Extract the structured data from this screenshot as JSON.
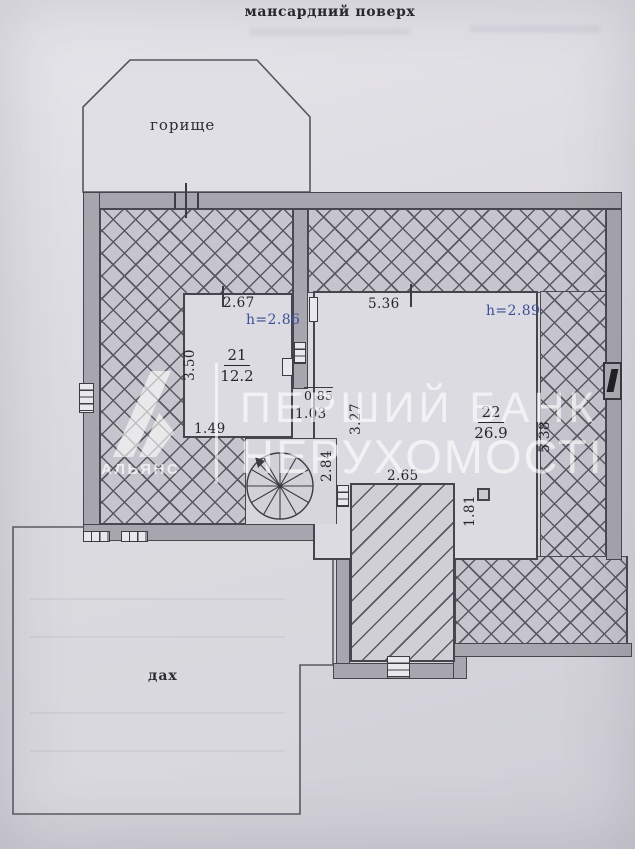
{
  "title": "мансардний поверх",
  "labels": {
    "attic": "горище",
    "roof": "дах"
  },
  "rooms": [
    {
      "number": "21",
      "area": "12.2",
      "height": "h=2.86"
    },
    {
      "number": "22",
      "area": "26.9",
      "height": "h=2.89"
    }
  ],
  "dims": {
    "room21_width": "2.67",
    "room21_depth": "3.50",
    "room21_niche": "1.49",
    "room22_width": "5.36",
    "room22_depth": "5.38",
    "door": "0.85",
    "passage": "1.03",
    "mid_wall": "3.27",
    "stairwell": "2.84",
    "terrace_width": "2.65",
    "terrace_depth": "1.81"
  },
  "watermark": {
    "brand": "АЛЬЯНС",
    "line1": "ПЕРШИЙ БАНК",
    "line2": "НЕРУХОМОСТІ"
  },
  "colors": {
    "height_dim_blue": "#3c4e97",
    "ink": "#26262c",
    "wall_fill": "#a7a6ae",
    "paper": "#d9d8de",
    "hatch_line": "#5a5962",
    "watermark_white": "rgba(255,255,255,0.62)"
  }
}
